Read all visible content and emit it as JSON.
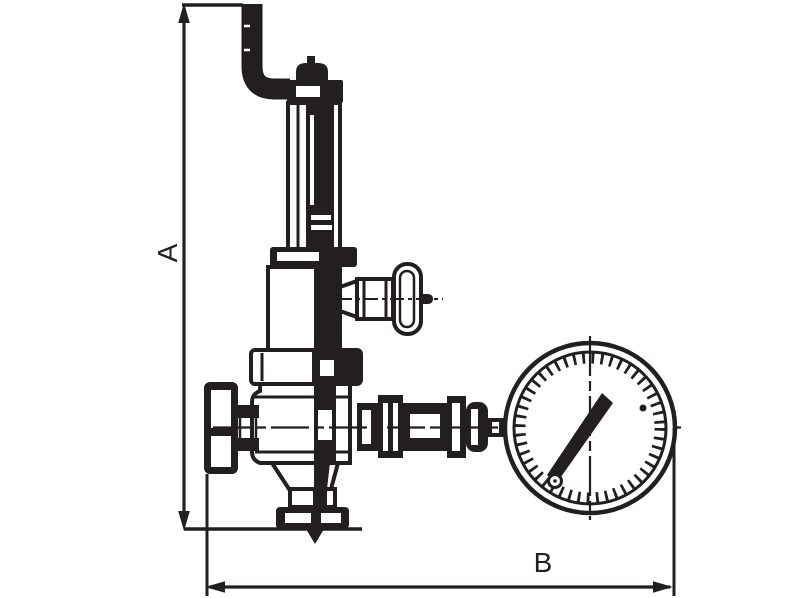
{
  "diagram": {
    "type": "technical-line-drawing",
    "line_color": "#231f20",
    "background_color": "#ffffff",
    "labels": {
      "vertical_dimension": "A",
      "horizontal_dimension": "B"
    }
  }
}
